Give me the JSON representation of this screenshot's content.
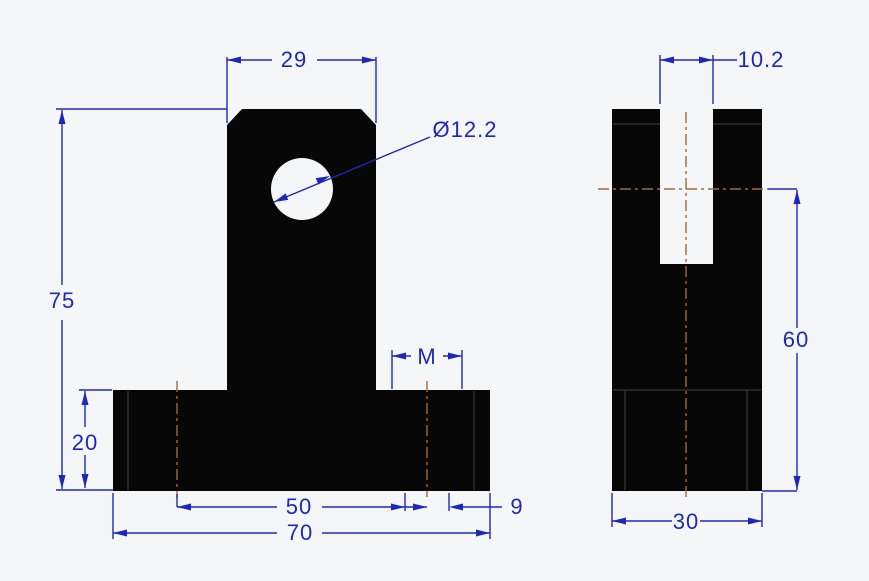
{
  "drawing": {
    "type": "engineering-drawing",
    "part": "T-shaped mounting bracket, front and side orthographic views",
    "colors": {
      "background": "#f5f6f8",
      "part": "#070707",
      "dimension": "#1e28b8",
      "centerline": "#a06a38",
      "edge": "#2e2e2e"
    },
    "front_view": {
      "dim_top_width": "29",
      "dim_hole_diameter": "Ø12.2",
      "dim_overall_height": "75",
      "dim_base_height": "20",
      "dim_thread_label": "M",
      "dim_hole_spacing": "50",
      "dim_hole_width": "9",
      "dim_base_width": "70"
    },
    "side_view": {
      "dim_slot_width": "10.2",
      "dim_center_height": "60",
      "dim_depth": "30"
    }
  }
}
